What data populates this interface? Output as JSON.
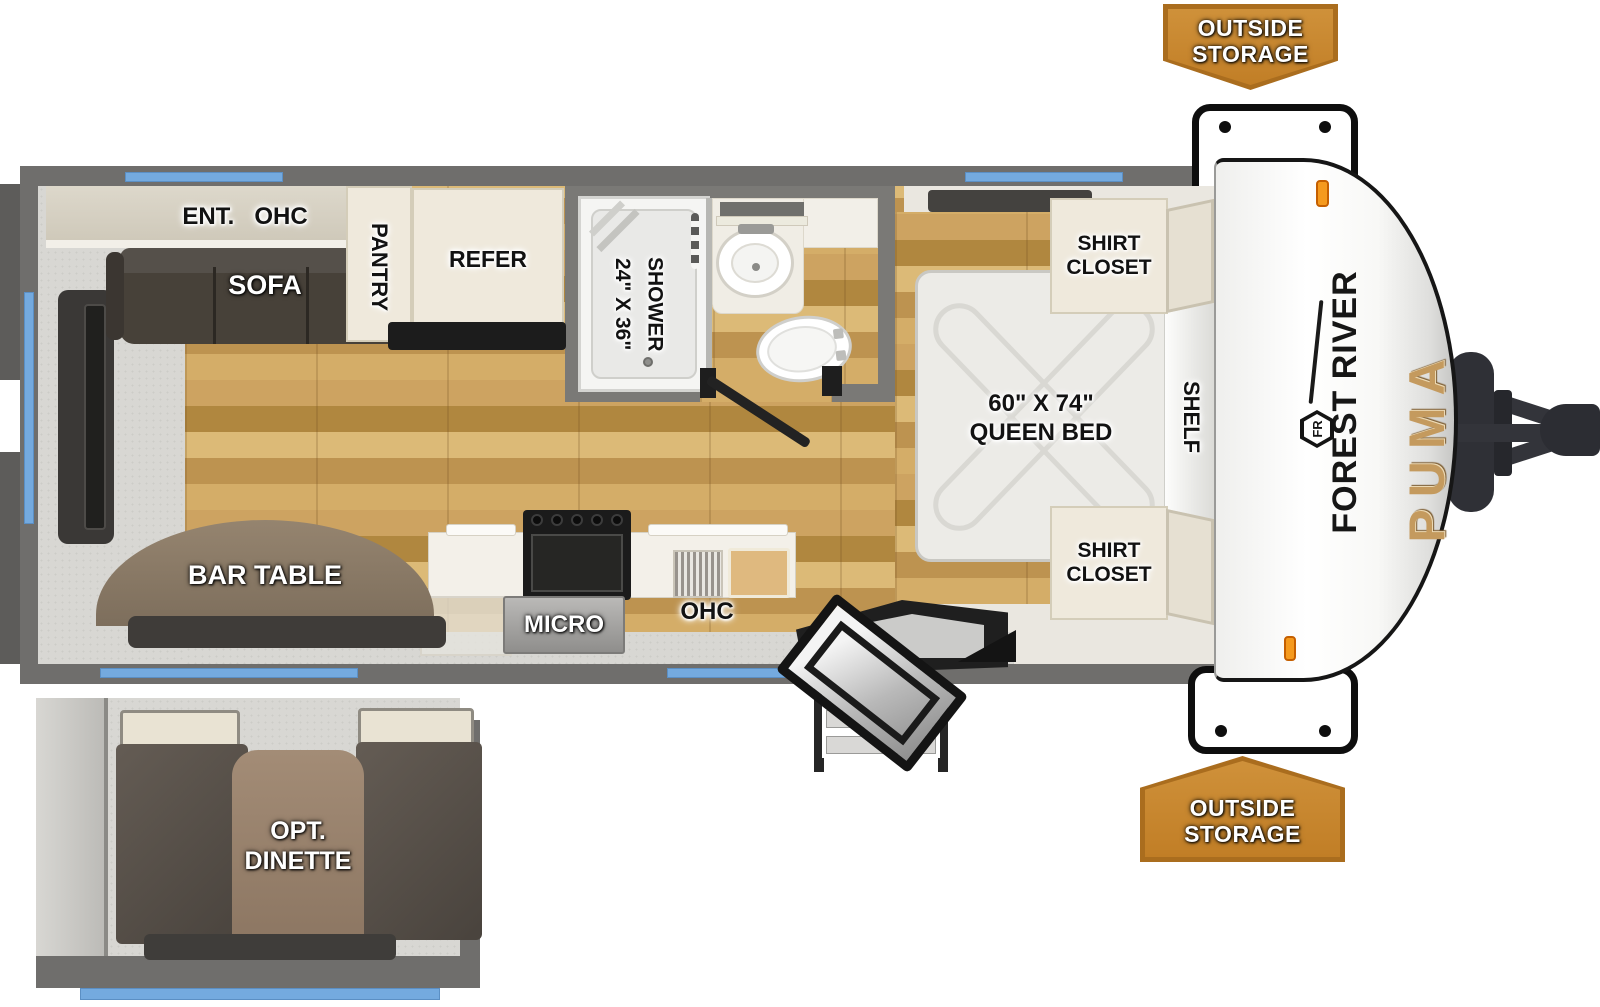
{
  "meta": {
    "title": "Forest River Puma travel trailer floor plan"
  },
  "colors": {
    "accent_orange": "#c6862f",
    "orange_border": "#aa6d1e",
    "window_blue": "#74aadf",
    "wall_gray": "#6f6e6c",
    "wood_floor": "#c8a25e",
    "puma_gold": "#c49a5e"
  },
  "callouts": {
    "outside_storage_top": "OUTSIDE\nSTORAGE",
    "outside_storage_bottom": "OUTSIDE\nSTORAGE"
  },
  "living": {
    "ent_ohc": "ENT.   OHC",
    "sofa": "SOFA",
    "pantry": "PANTRY",
    "refer": "REFER",
    "bar_table": "BAR TABLE"
  },
  "kitchen": {
    "micro": "MICRO",
    "ohc": "OHC"
  },
  "bathroom": {
    "shower": "24\" X 36\"\nSHOWER"
  },
  "bedroom": {
    "queen_bed": "60\" X 74\"\nQUEEN BED",
    "shelf": "SHELF",
    "shirt_closet_top": "SHIRT\nCLOSET",
    "shirt_closet_bottom": "SHIRT\nCLOSET"
  },
  "dinette": {
    "label": "OPT.\nDINETTE"
  },
  "branding": {
    "make": "FOREST RIVER",
    "model": "PUMA",
    "logo_monogram": "FR"
  }
}
